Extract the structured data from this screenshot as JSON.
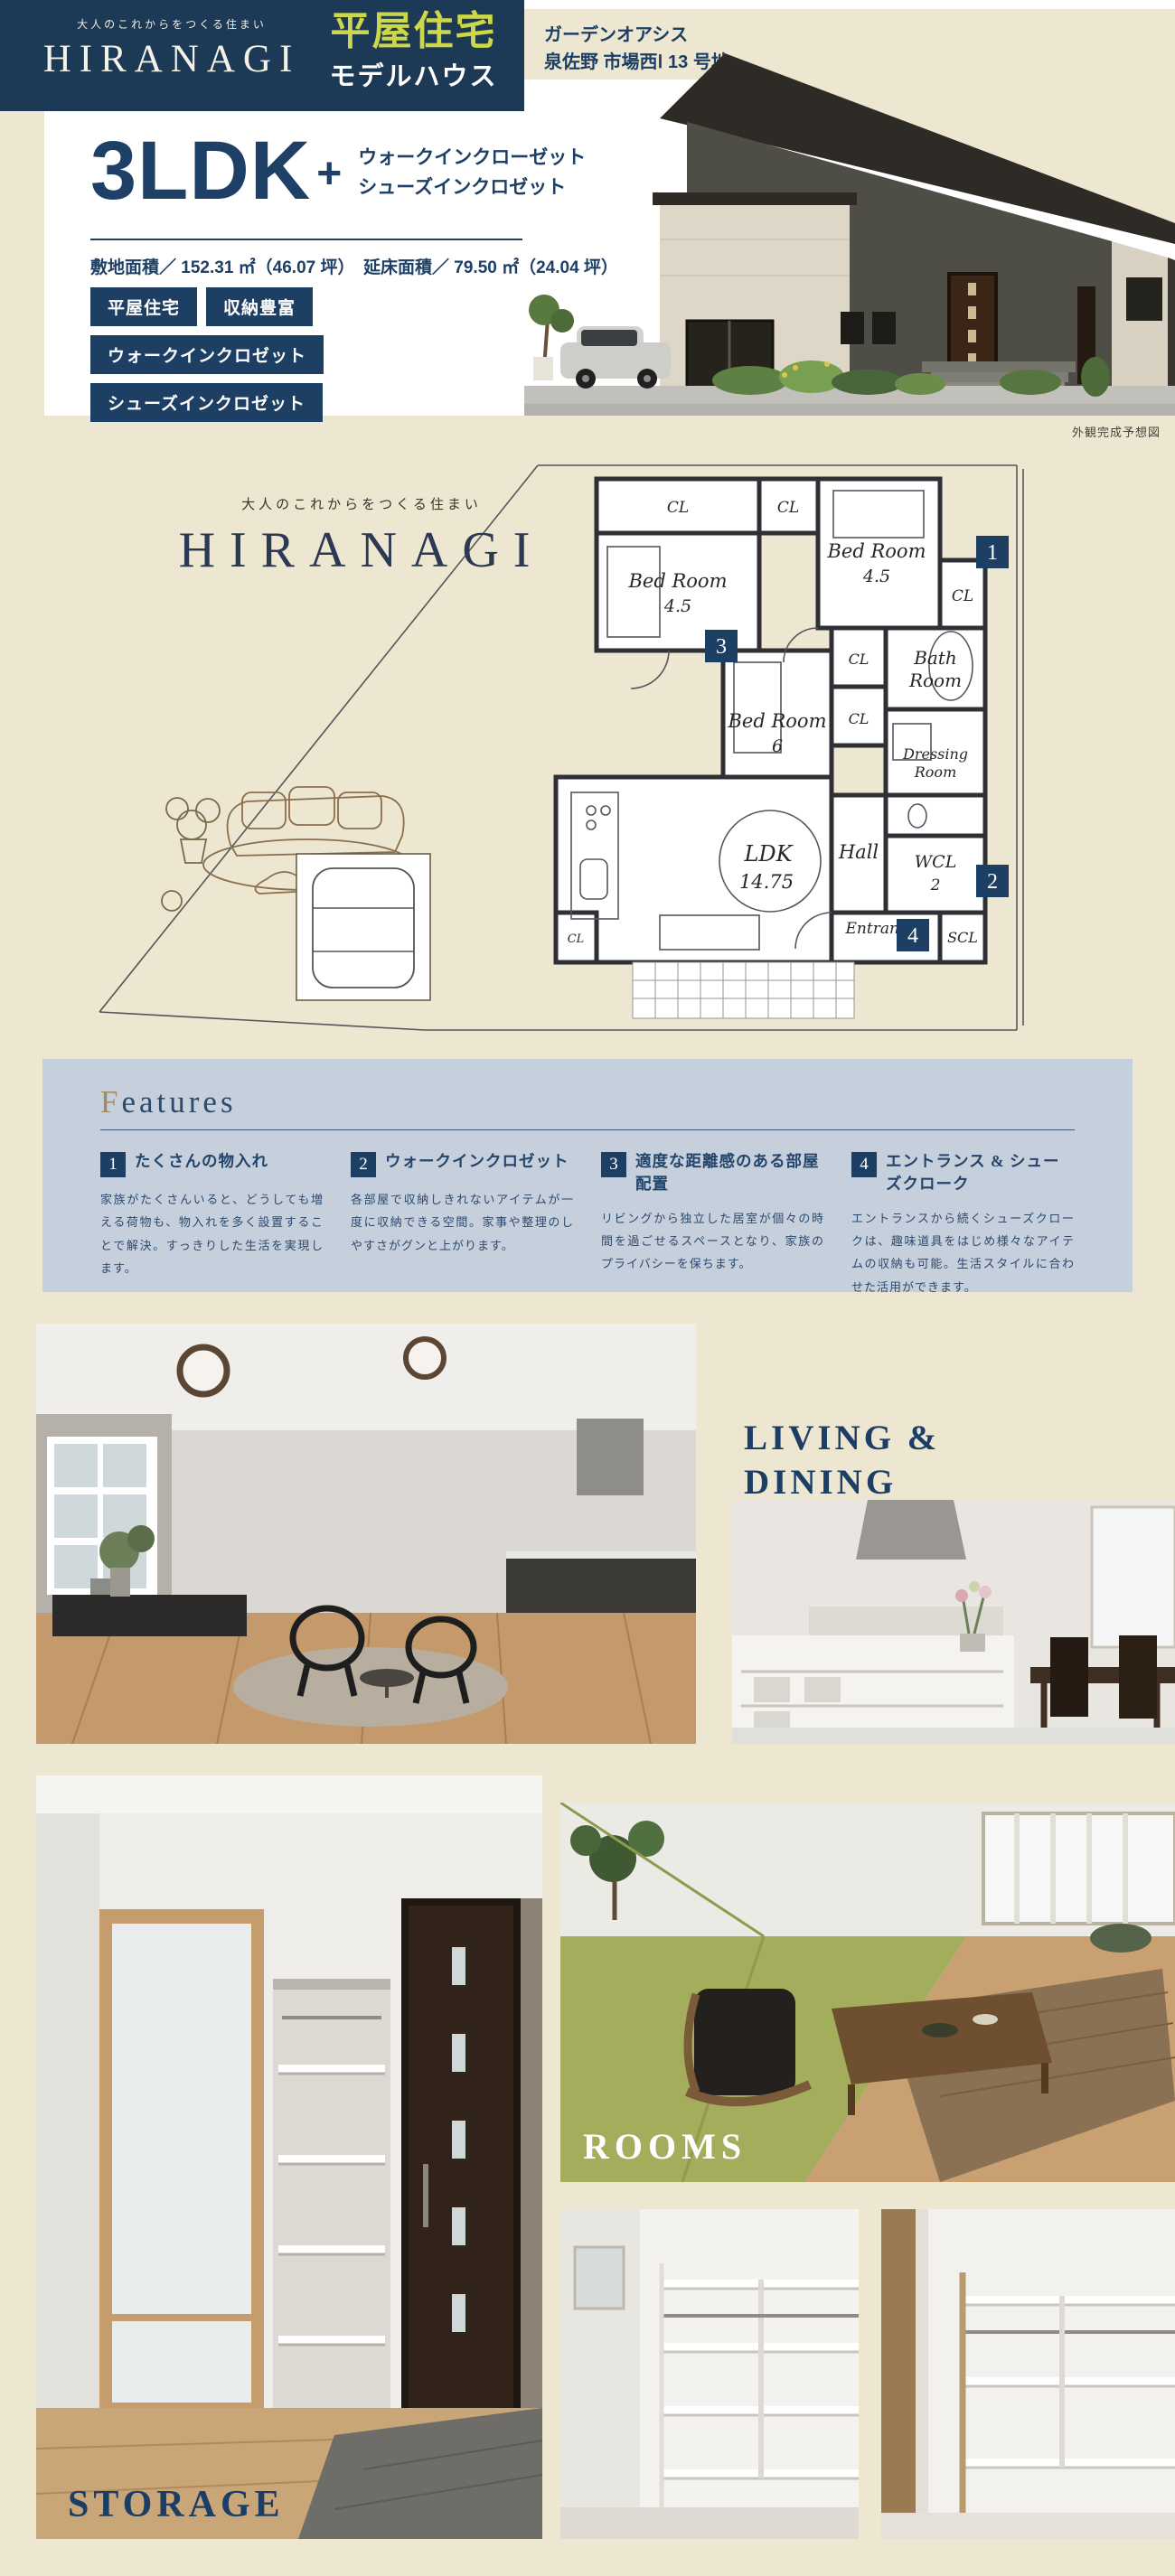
{
  "colors": {
    "navy": "#1C3A55",
    "text_navy": "#1E3F66",
    "accent_yellow_green": "#CCD74A",
    "cream": "#EDE6D0",
    "features_bg": "#C6CFDC",
    "gold_initial": "#A5885E",
    "white": "#FFFFFF"
  },
  "header": {
    "tagline": "大人のこれからをつくる住まい",
    "brand": "HIRANAGI",
    "badge_line1": "平屋住宅",
    "badge_line2": "モデルハウス",
    "location_line1": "ガーデンオアシス",
    "location_line2": "泉佐野 市場西Ⅰ 13 号地"
  },
  "hero": {
    "plan_title": "3LDK",
    "plan_plus": "+",
    "plan_sub1": "ウォークインクローゼット",
    "plan_sub2": "シューズインクロゼット",
    "area_line": "敷地面積／ 152.31 ㎡（46.07 坪）　延床面積／ 79.50 ㎡（24.04 坪）",
    "tags": [
      "平屋住宅",
      "収納豊富",
      "ウォークインクロゼット",
      "シューズインクロゼット"
    ],
    "exterior_caption": "外観完成予想図"
  },
  "floorplan": {
    "tagline": "大人のこれからをつくる住まい",
    "brand": "HIRANAGI",
    "rooms": {
      "cl_a": "CL",
      "cl_top": "CL",
      "cl_right": "CL",
      "cl_mid1": "CL",
      "cl_mid2": "CL",
      "cl_ldk": "CL",
      "bed_a1": "Bed Room",
      "bed_a2": "4.5",
      "bed_b1": "Bed Room",
      "bed_b2": "4.5",
      "bed_c1": "Bed Room",
      "bed_c2": "6",
      "bath1": "Bath",
      "bath2": "Room",
      "dress1": "Dressing",
      "dress2": "Room",
      "hall": "Hall",
      "wcl1": "WCL",
      "wcl2": "2",
      "ldk1": "LDK",
      "ldk2": "14.75",
      "entrance": "Entrance",
      "scl": "SCL"
    },
    "badges": {
      "b1": "1",
      "b2": "2",
      "b3": "3",
      "b4": "4"
    }
  },
  "features": {
    "title": "Features",
    "items": [
      {
        "num": "1",
        "title": "たくさんの物入れ",
        "body": "家族がたくさんいると、どうしても増える荷物も、物入れを多く設置することで解決。すっきりした生活を実現します。"
      },
      {
        "num": "2",
        "title": "ウォークインクロゼット",
        "body": "各部屋で収納しきれないアイテムが一度に収納できる空間。家事や整理のしやすさがグンと上がります。"
      },
      {
        "num": "3",
        "title": "適度な距離感のある部屋配置",
        "body": "リビングから独立した居室が個々の時間を過ごせるスペースとなり、家族のプライバシーを保ちます。"
      },
      {
        "num": "4",
        "title": "エントランス & シューズクローク",
        "body": "エントランスから続くシューズクロークは、趣味道具をはじめ様々なアイテムの収納も可能。生活スタイルに合わせた活用ができます。"
      }
    ]
  },
  "sections": {
    "living_title_line1": "LIVING &",
    "living_title_line2": "DINING",
    "rooms_label": "ROOMS",
    "storage_label": "STORAGE"
  }
}
